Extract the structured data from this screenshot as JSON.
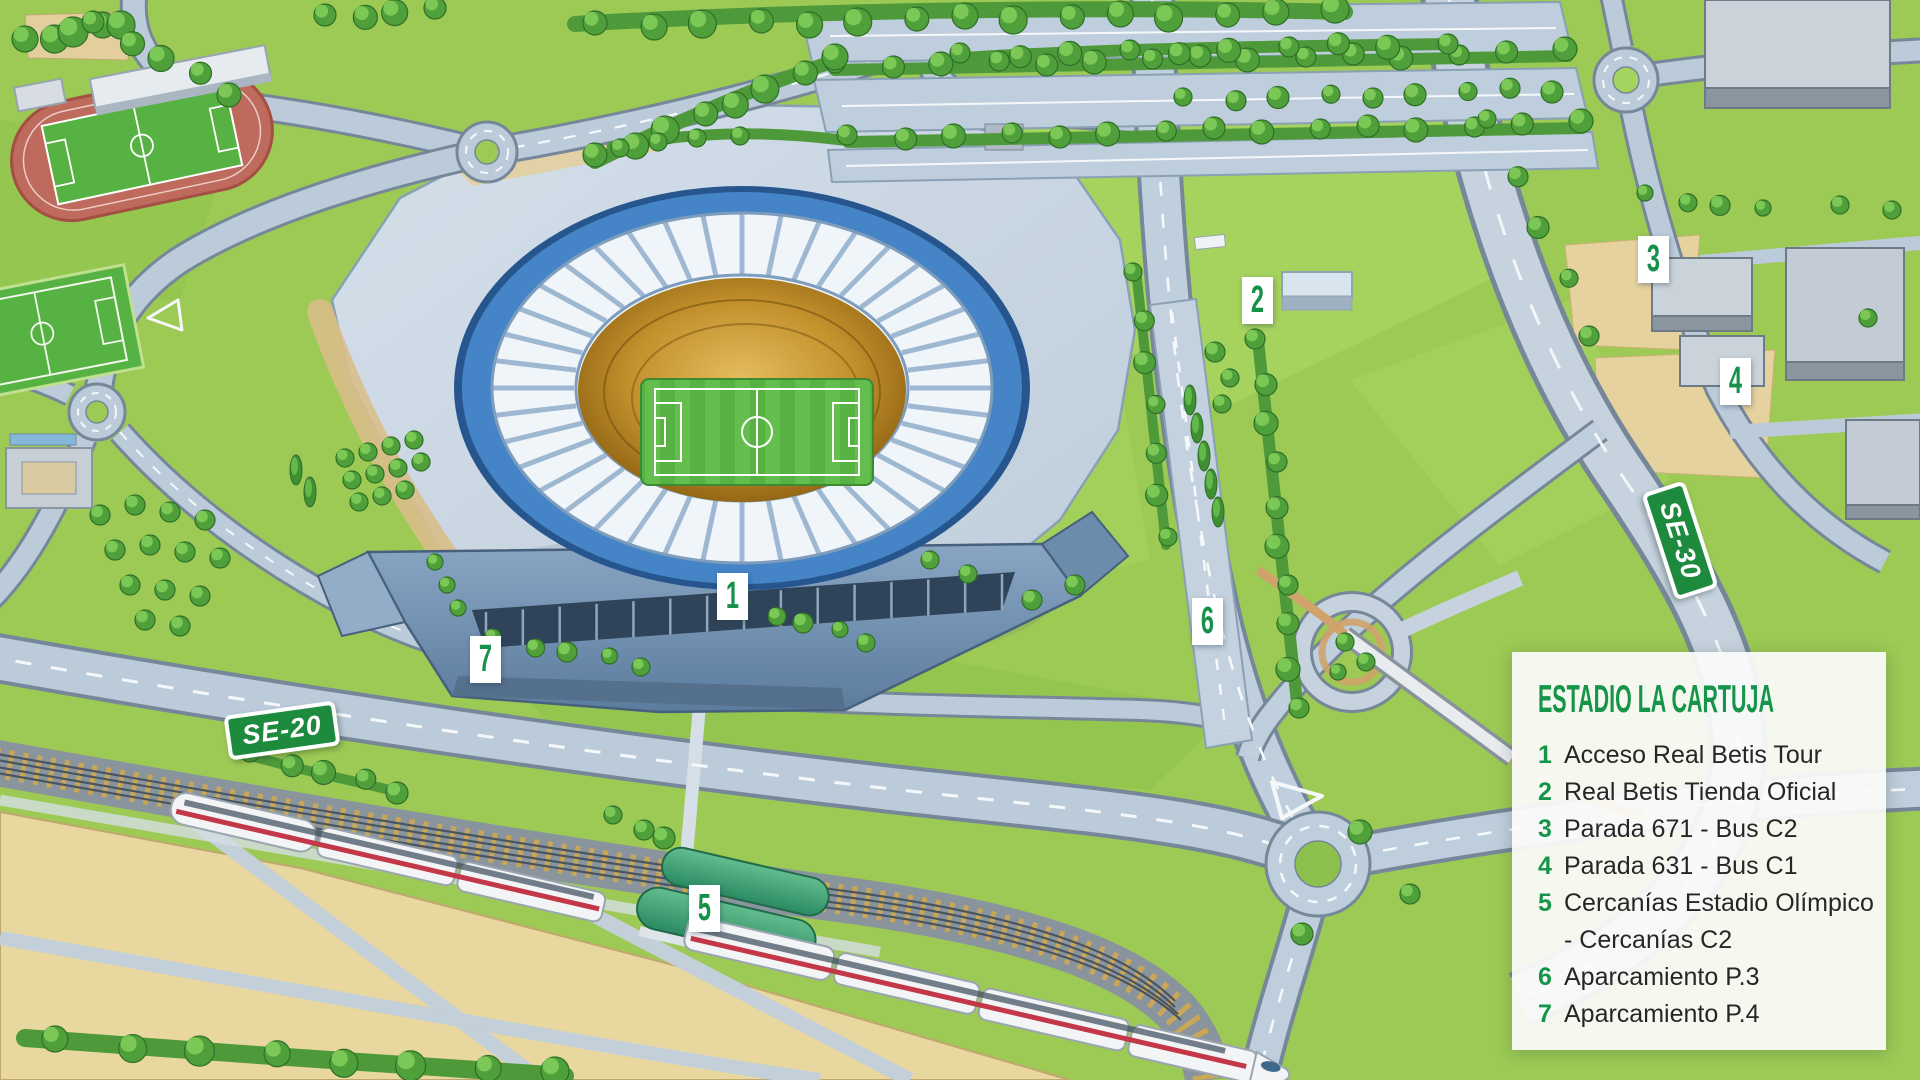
{
  "colors": {
    "accent": "#16954A",
    "legend_number": "#16954A",
    "legend_text": "#262626",
    "panel_bg": "#FBFCFA",
    "sign_green": "#1D8A3E",
    "marker_digit": "#16914A",
    "marker_bg": "#FFFFFF"
  },
  "legend": {
    "title": "ESTADIO LA CARTUJA",
    "items": [
      {
        "number": "1",
        "label": "Acceso Real Betis Tour"
      },
      {
        "number": "2",
        "label": "Real Betis Tienda Oficial"
      },
      {
        "number": "3",
        "label": "Parada 671 - Bus C2"
      },
      {
        "number": "4",
        "label": "Parada 631 - Bus C1"
      },
      {
        "number": "5",
        "label": "Cercanías Estadio Olímpico",
        "label2": "- Cercanías C2"
      },
      {
        "number": "6",
        "label": "Aparcamiento P.3"
      },
      {
        "number": "7",
        "label": "Aparcamiento P.4"
      }
    ]
  },
  "signs": {
    "se20": "SE-20",
    "se30": "SE-30"
  },
  "map": {
    "markers": [
      {
        "number": "1"
      },
      {
        "number": "2"
      },
      {
        "number": "3"
      },
      {
        "number": "4"
      },
      {
        "number": "5"
      },
      {
        "number": "6"
      },
      {
        "number": "7"
      }
    ]
  }
}
